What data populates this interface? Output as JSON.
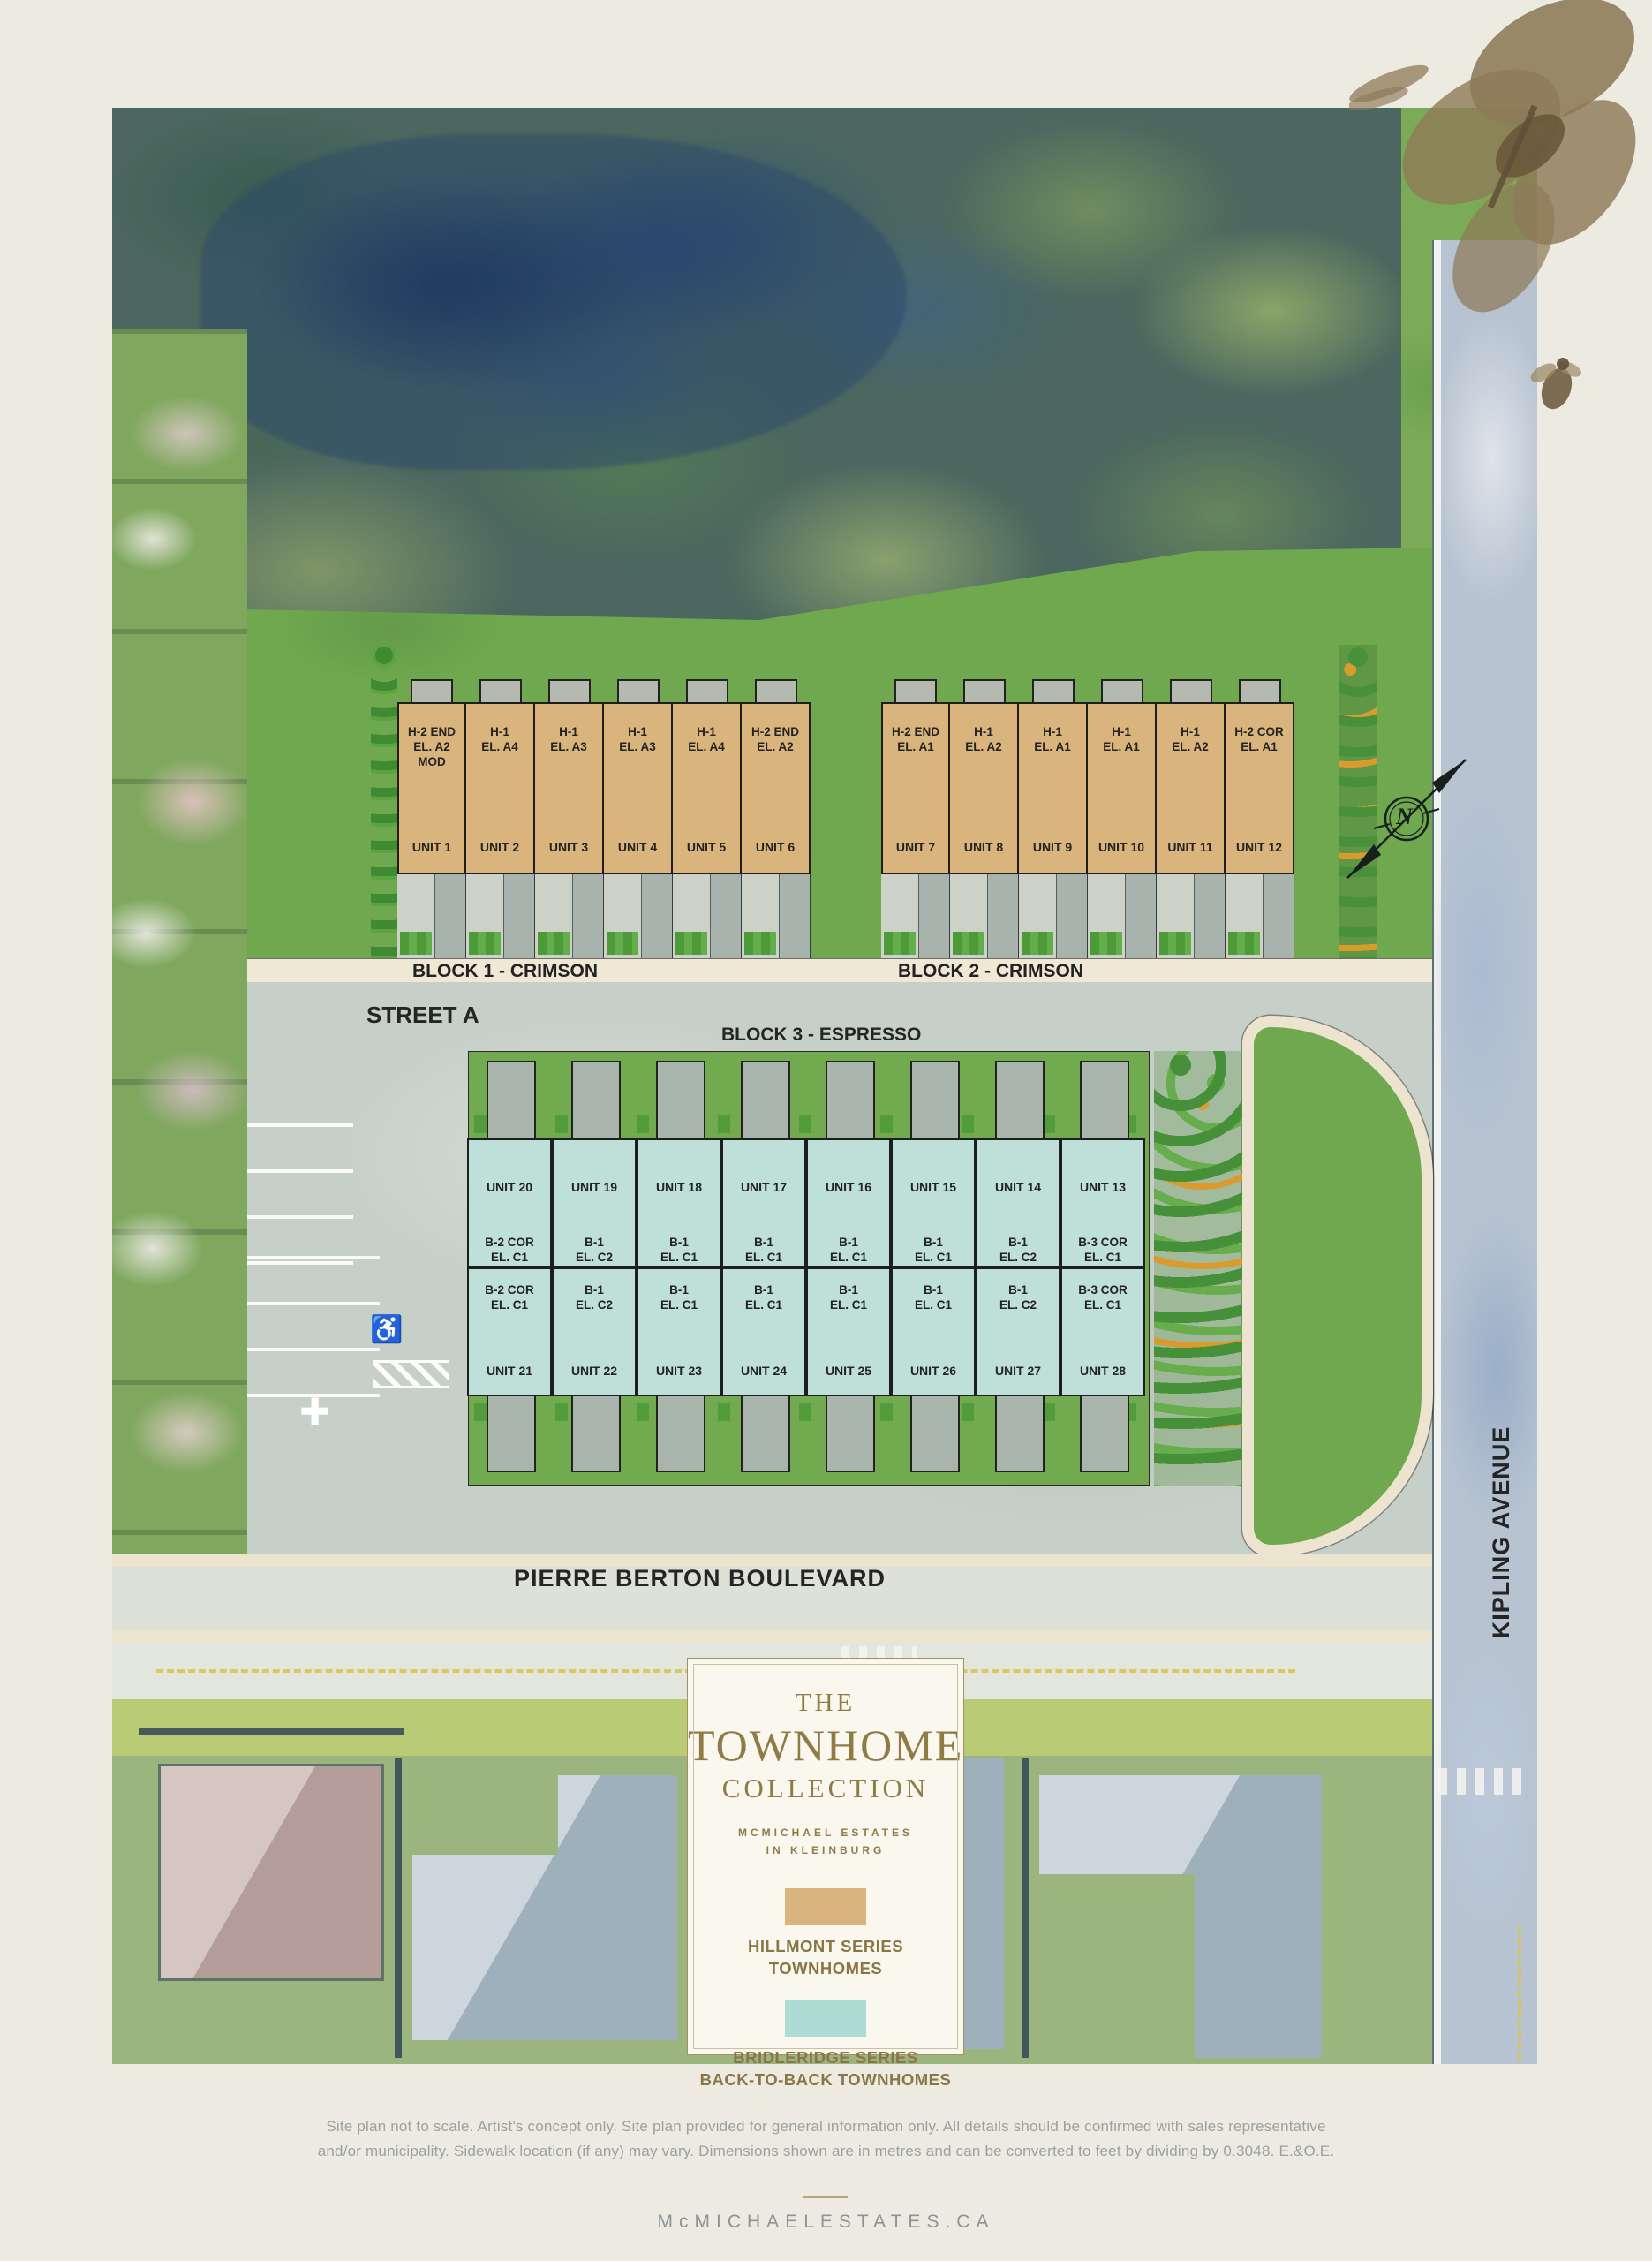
{
  "map": {
    "north_label": "N",
    "street_a": "STREET A",
    "pierre_berton": "PIERRE BERTON BOULEVARD",
    "kipling": "KIPLING AVENUE",
    "icons": {
      "accessible": "♿",
      "junction": "✚"
    }
  },
  "blocks": {
    "block1": {
      "label": "BLOCK 1 - CRIMSON",
      "units": [
        {
          "unit": "UNIT 1",
          "model": "H-2 END",
          "el": "EL. A2",
          "mod": "MOD"
        },
        {
          "unit": "UNIT 2",
          "model": "H-1",
          "el": "EL. A4"
        },
        {
          "unit": "UNIT 3",
          "model": "H-1",
          "el": "EL. A3"
        },
        {
          "unit": "UNIT 4",
          "model": "H-1",
          "el": "EL. A3"
        },
        {
          "unit": "UNIT 5",
          "model": "H-1",
          "el": "EL. A4"
        },
        {
          "unit": "UNIT 6",
          "model": "H-2 END",
          "el": "EL. A2"
        }
      ]
    },
    "block2": {
      "label": "BLOCK 2 - CRIMSON",
      "units": [
        {
          "unit": "UNIT 7",
          "model": "H-2 END",
          "el": "EL. A1"
        },
        {
          "unit": "UNIT 8",
          "model": "H-1",
          "el": "EL. A2"
        },
        {
          "unit": "UNIT 9",
          "model": "H-1",
          "el": "EL. A1"
        },
        {
          "unit": "UNIT 10",
          "model": "H-1",
          "el": "EL. A1"
        },
        {
          "unit": "UNIT 11",
          "model": "H-1",
          "el": "EL. A2"
        },
        {
          "unit": "UNIT 12",
          "model": "H-2 COR",
          "el": "EL. A1"
        }
      ]
    },
    "block3": {
      "label": "BLOCK 3 -  ESPRESSO",
      "top_row": [
        {
          "unit": "UNIT 20",
          "model": "B-2 COR",
          "el": "EL. C1"
        },
        {
          "unit": "UNIT 19",
          "model": "B-1",
          "el": "EL. C2"
        },
        {
          "unit": "UNIT 18",
          "model": "B-1",
          "el": "EL. C1"
        },
        {
          "unit": "UNIT 17",
          "model": "B-1",
          "el": "EL. C1"
        },
        {
          "unit": "UNIT 16",
          "model": "B-1",
          "el": "EL. C1"
        },
        {
          "unit": "UNIT 15",
          "model": "B-1",
          "el": "EL. C1"
        },
        {
          "unit": "UNIT 14",
          "model": "B-1",
          "el": "EL. C2"
        },
        {
          "unit": "UNIT 13",
          "model": "B-3 COR",
          "el": "EL. C1"
        }
      ],
      "bottom_row": [
        {
          "unit": "UNIT 21",
          "model": "B-2 COR",
          "el": "EL. C1"
        },
        {
          "unit": "UNIT 22",
          "model": "B-1",
          "el": "EL. C2"
        },
        {
          "unit": "UNIT 23",
          "model": "B-1",
          "el": "EL. C1"
        },
        {
          "unit": "UNIT 24",
          "model": "B-1",
          "el": "EL. C1"
        },
        {
          "unit": "UNIT 25",
          "model": "B-1",
          "el": "EL. C1"
        },
        {
          "unit": "UNIT 26",
          "model": "B-1",
          "el": "EL. C1"
        },
        {
          "unit": "UNIT 27",
          "model": "B-1",
          "el": "EL. C2"
        },
        {
          "unit": "UNIT 28",
          "model": "B-3 COR",
          "el": "EL. C1"
        }
      ]
    }
  },
  "legend": {
    "title_line1": "THE",
    "title_line2": "TOWNHOME",
    "title_line3": "COLLECTION",
    "subtitle_line1": "MCMICHAEL ESTATES",
    "subtitle_line2": "IN KLEINBURG",
    "items": [
      {
        "swatch": "#d9b47c",
        "line1": "HILLMONT SERIES",
        "line2": "TOWNHOMES"
      },
      {
        "swatch": "#aedbd3",
        "line1": "BRIDLERIDGE SERIES",
        "line2": "BACK-TO-BACK TOWNHOMES"
      }
    ]
  },
  "footer": {
    "disclaimer_line1": "Site plan not to scale. Artist's concept only. Site plan provided for general information only. All details should be confirmed with sales representative",
    "disclaimer_line2": "and/or municipality. Sidewalk location (if any) may vary. Dimensions shown are in metres and can be converted to feet by dividing by 0.3048. E.&O.E.",
    "site_url": "McMICHAELESTATES.CA"
  },
  "colors": {
    "hillmont_tan": "#d9b47c",
    "bridleridge_teal": "#bfe0d8",
    "gold_accent": "#8f7b45",
    "street_gray": "#c7d0c8",
    "lawn_green": "#6fa84e"
  }
}
